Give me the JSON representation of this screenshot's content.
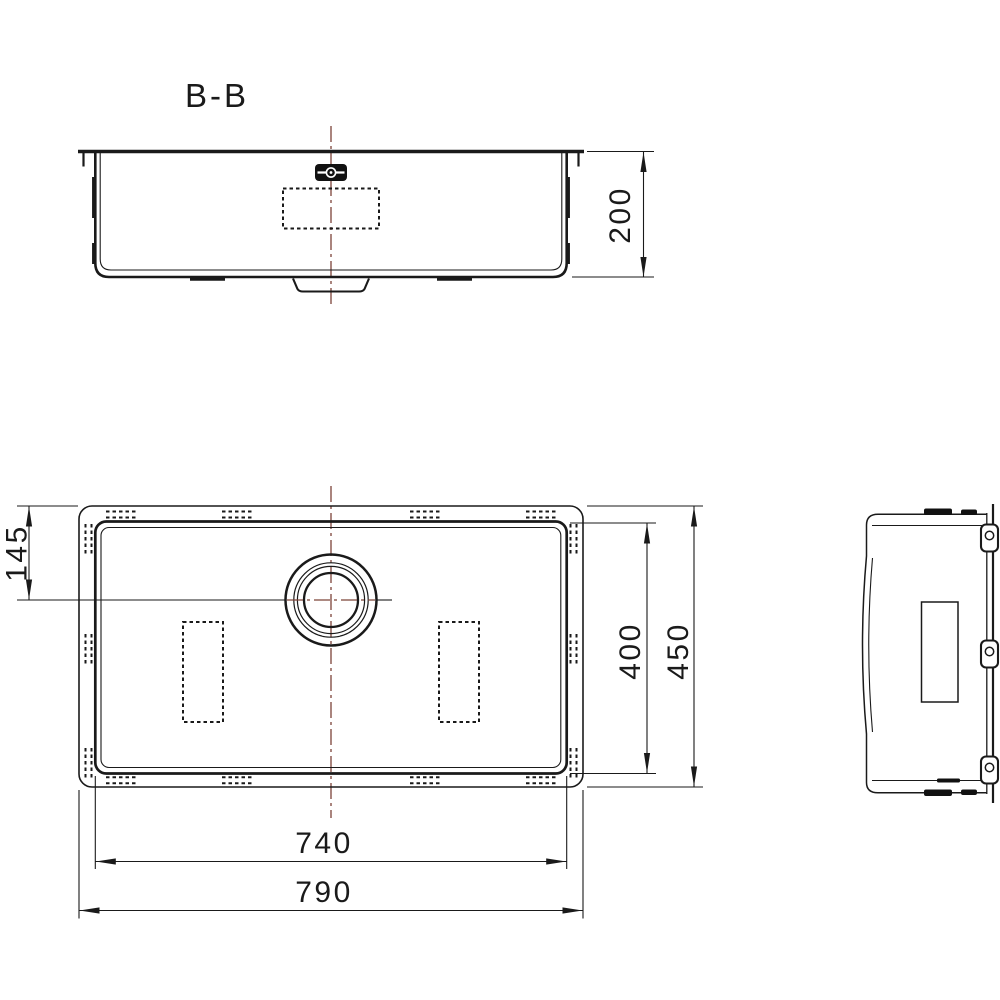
{
  "colors": {
    "background": "#ffffff",
    "line": "#1a1a1a",
    "centerline": "#7c4338"
  },
  "section_view": {
    "label": "B-B",
    "dims": {
      "depth": "200"
    }
  },
  "plan_view": {
    "dims": {
      "drain_center_from_top": "145",
      "inner_width": "400",
      "outer_width": "450",
      "inner_length": "740",
      "outer_length": "790"
    }
  }
}
